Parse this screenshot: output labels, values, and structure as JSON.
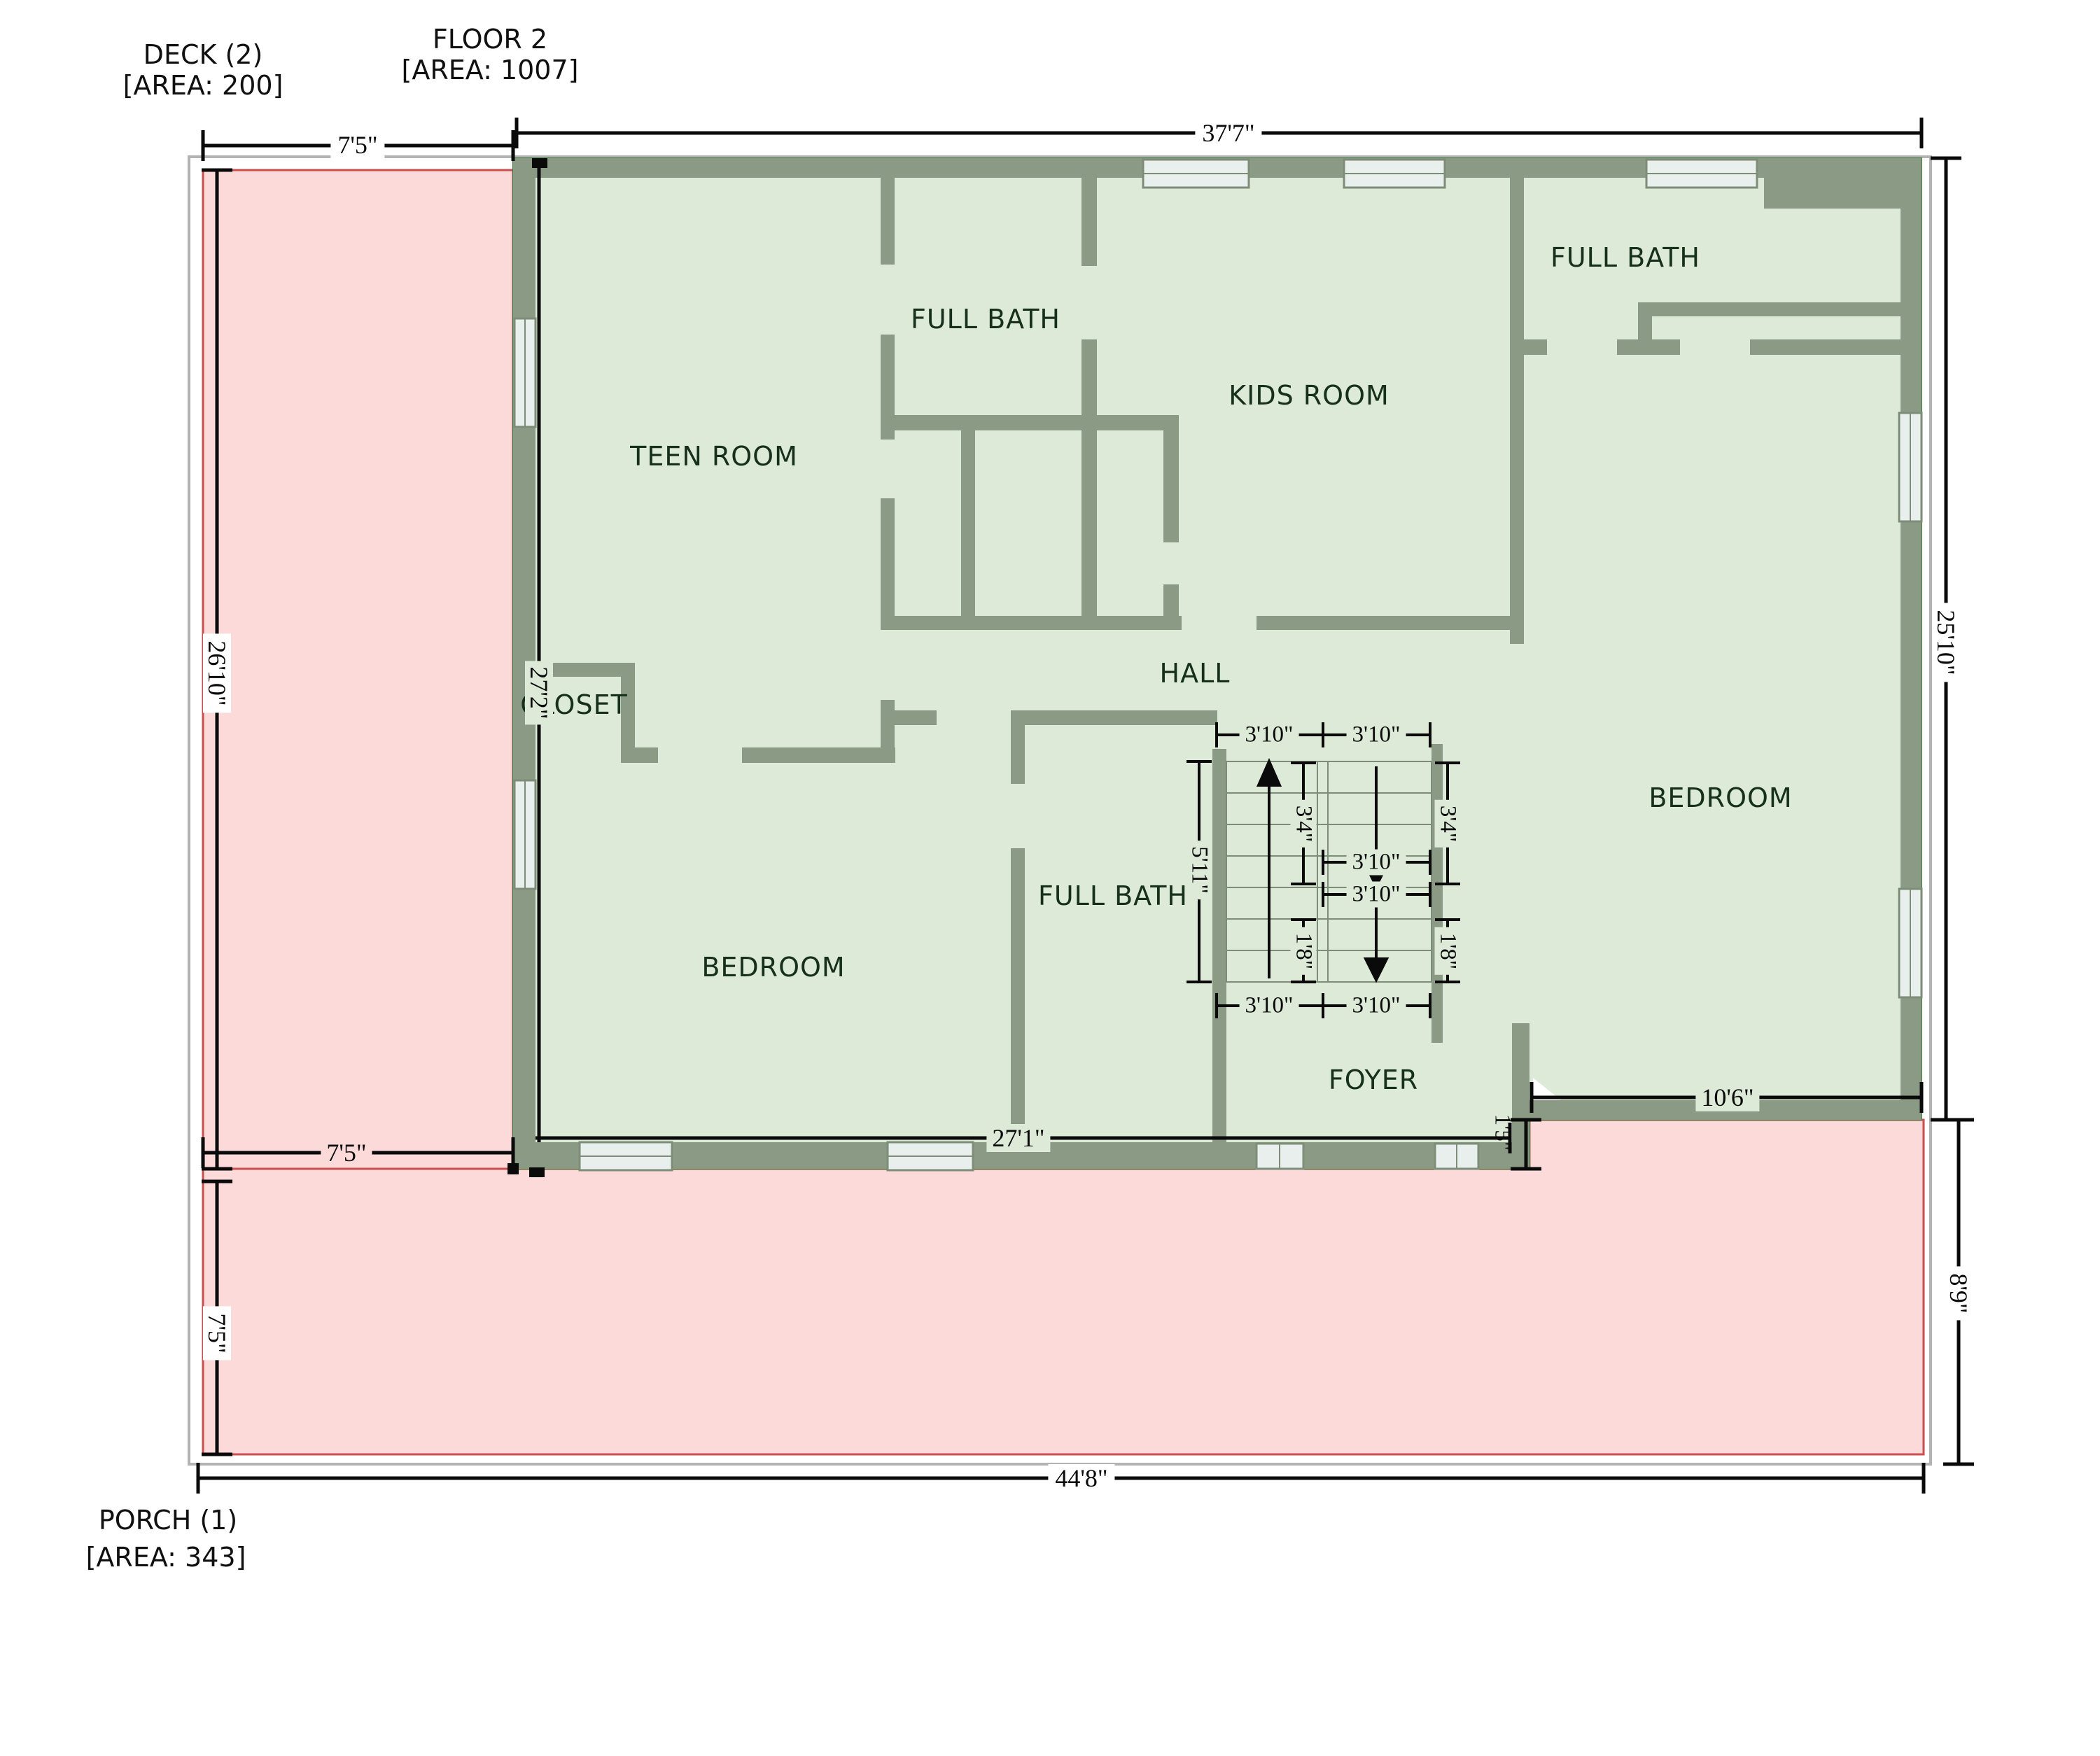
{
  "colors": {
    "wall": "#8a9a84",
    "floor": "#dcead7",
    "door_gap": "#e9f2e7",
    "deck_porch_fill": "#fcdada",
    "deck_porch_border": "#c94f4f",
    "window_fill": "#e8efec",
    "boundary": "#b3b3b3",
    "dimension": "#0a0a0a"
  },
  "titles": {
    "deck": "DECK (2)",
    "deck_area": "[AREA: 200]",
    "floor": "FLOOR 2",
    "floor_area": "[AREA: 1007]",
    "porch": "PORCH (1)",
    "porch_area": "[AREA: 343]"
  },
  "rooms": {
    "teen": "TEEN ROOM",
    "bath_top": "FULL BATH",
    "kids": "KIDS ROOM",
    "bath_right": "FULL BATH",
    "closet": "CLOSET",
    "hall": "HALL",
    "bedroom_left": "BEDROOM",
    "bath_mid": "FULL BATH",
    "bedroom_right": "BEDROOM",
    "foyer": "FOYER"
  },
  "dims": {
    "deck_width": "7'5\"",
    "floor_width": "37'7\"",
    "deck_height": "26'10\"",
    "interior_height": "27'2\"",
    "right_height": "25'10\"",
    "interior_width": "27'1\"",
    "deck_width_b": "7'5\"",
    "step": "1'5\"",
    "bed_right_width": "10'6\"",
    "porch_left": "7'5\"",
    "porch_right": "8'9\"",
    "porch_width": "44'8\"",
    "stair_tl": "3'10\"",
    "stair_tr": "3'10\"",
    "stair_bl": "3'10\"",
    "stair_br": "3'10\"",
    "stair_m1": "3'10\"",
    "stair_m2": "3'10\"",
    "stair_l1": "3'4\"",
    "stair_l2": "1'8\"",
    "stair_r1": "3'4\"",
    "stair_r2": "1'8\"",
    "stair_len": "5'11\""
  }
}
